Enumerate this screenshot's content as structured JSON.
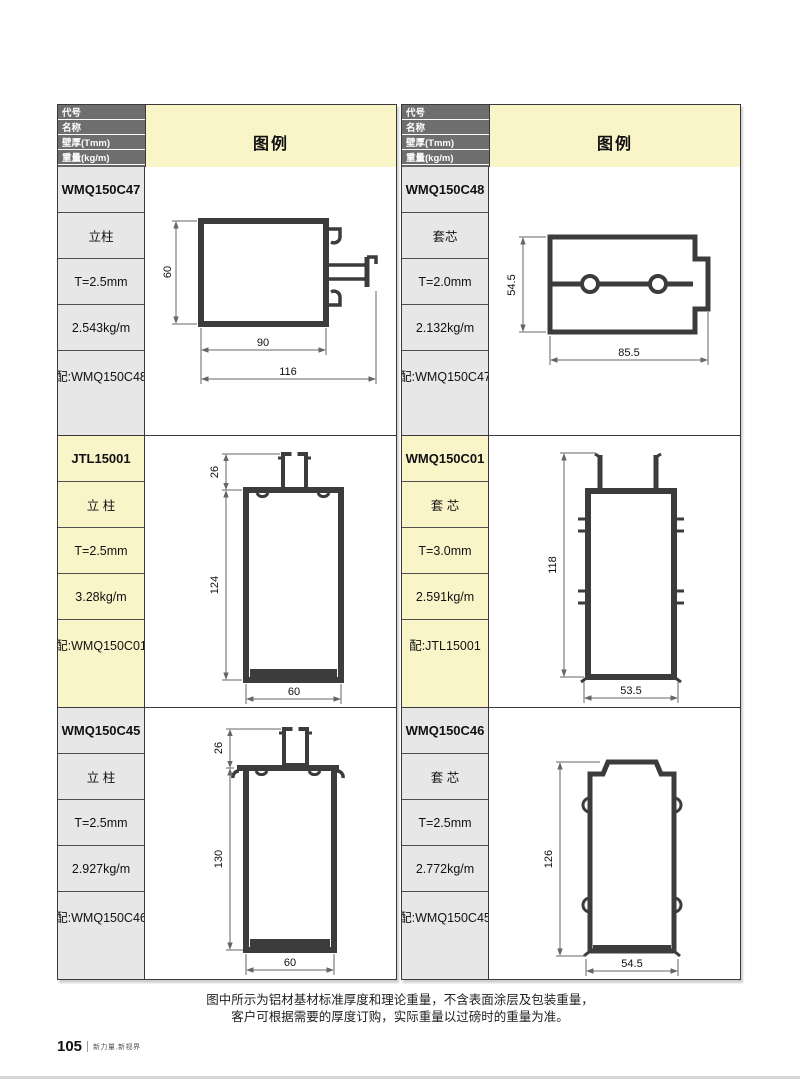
{
  "header": {
    "field_labels": [
      "代号",
      "名称",
      "壁厚(Tmm)",
      "重量(kg/m)",
      "配套"
    ],
    "legend_label": "图例"
  },
  "tables": [
    {
      "entries": [
        {
          "code": "WMQ150C47",
          "name": "立柱",
          "thickness": "T=2.5mm",
          "weight": "2.543kg/m",
          "match": "配:WMQ150C48",
          "dims": {
            "height": "60",
            "inner_width": "90",
            "total_width": "116"
          }
        },
        {
          "code": "JTL15001",
          "name": "立 柱",
          "thickness": "T=2.5mm",
          "weight": "3.28kg/m",
          "match": "配:WMQ150C01",
          "dims": {
            "tab": "26",
            "height": "124",
            "width": "60"
          }
        },
        {
          "code": "WMQ150C45",
          "name": "立 柱",
          "thickness": "T=2.5mm",
          "weight": "2.927kg/m",
          "match": "配:WMQ150C46",
          "dims": {
            "tab": "26",
            "height": "130",
            "width": "60"
          }
        }
      ]
    },
    {
      "entries": [
        {
          "code": "WMQ150C48",
          "name": "套芯",
          "thickness": "T=2.0mm",
          "weight": "2.132kg/m",
          "match": "配:WMQ150C47",
          "dims": {
            "height": "54.5",
            "width": "85.5"
          }
        },
        {
          "code": "WMQ150C01",
          "name": "套 芯",
          "thickness": "T=3.0mm",
          "weight": "2.591kg/m",
          "match": "配:JTL15001",
          "dims": {
            "height": "118",
            "width": "53.5"
          }
        },
        {
          "code": "WMQ150C46",
          "name": "套 芯",
          "thickness": "T=2.5mm",
          "weight": "2.772kg/m",
          "match": "配:WMQ150C45",
          "dims": {
            "height": "126",
            "width": "54.5"
          }
        }
      ]
    }
  ],
  "colors": {
    "header_band": "#6e6e6e",
    "legend_bg": "#faf5c9",
    "label_gray": "#e7e7e7",
    "label_yellow": "#faf5c9",
    "profile_stroke": "#3c3c3c"
  },
  "footer": {
    "note_line1": "图中所示为铝材基材标准厚度和理论重量，不含表面涂层及包装重量，",
    "note_line2": "客户可根据需要的厚度订购，实际重量以过磅时的重量为准。",
    "page_number": "105",
    "brand_text": "新力量.新视界"
  }
}
